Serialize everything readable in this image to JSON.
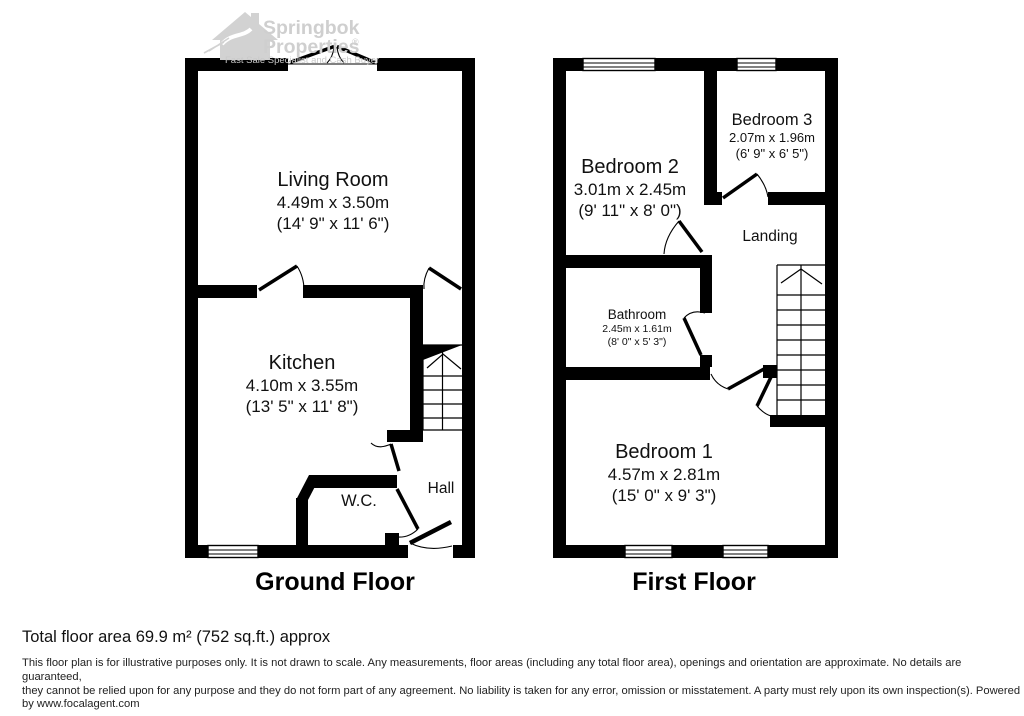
{
  "watermark": {
    "brand_line1": "Springbok",
    "brand_line2": "Properties",
    "reg_mark": "®",
    "tagline": "Fast Sale Specialist and Cash Buyer",
    "color": "#cfcfcf"
  },
  "colors": {
    "wall": "#000000",
    "background": "#ffffff",
    "text": "#111111"
  },
  "floors": [
    {
      "title": "Ground Floor",
      "rooms": [
        {
          "name": "Living Room",
          "dims_m": "4.49m x 3.50m",
          "dims_ft": "(14' 9\" x 11' 6\")"
        },
        {
          "name": "Kitchen",
          "dims_m": "4.10m x 3.55m",
          "dims_ft": "(13' 5\" x 11' 8\")"
        },
        {
          "name": "W.C."
        },
        {
          "name": "Hall"
        }
      ]
    },
    {
      "title": "First Floor",
      "rooms": [
        {
          "name": "Bedroom 2",
          "dims_m": "3.01m x 2.45m",
          "dims_ft": "(9' 11\" x 8' 0\")"
        },
        {
          "name": "Bedroom 3",
          "dims_m": "2.07m x 1.96m",
          "dims_ft": "(6' 9\" x 6' 5\")"
        },
        {
          "name": "Landing"
        },
        {
          "name": "Bathroom",
          "dims_m": "2.45m x 1.61m",
          "dims_ft": "(8' 0\" x 5' 3\")"
        },
        {
          "name": "Bedroom 1",
          "dims_m": "4.57m x 2.81m",
          "dims_ft": "(15' 0\" x 9' 3\")"
        }
      ]
    }
  ],
  "footer": {
    "total_area": "Total floor area 69.9 m² (752 sq.ft.) approx",
    "disclaimer_lines": [
      "This floor plan is for illustrative purposes only. It is not drawn to scale. Any measurements, floor areas (including any total floor area), openings and orientation are approximate. No details are guaranteed,",
      "they cannot be relied upon for any purpose and they do not form part of any agreement. No liability is taken for any error, omission or misstatement. A party must rely upon its own inspection(s). Powered",
      "by www.focalagent.com"
    ]
  }
}
